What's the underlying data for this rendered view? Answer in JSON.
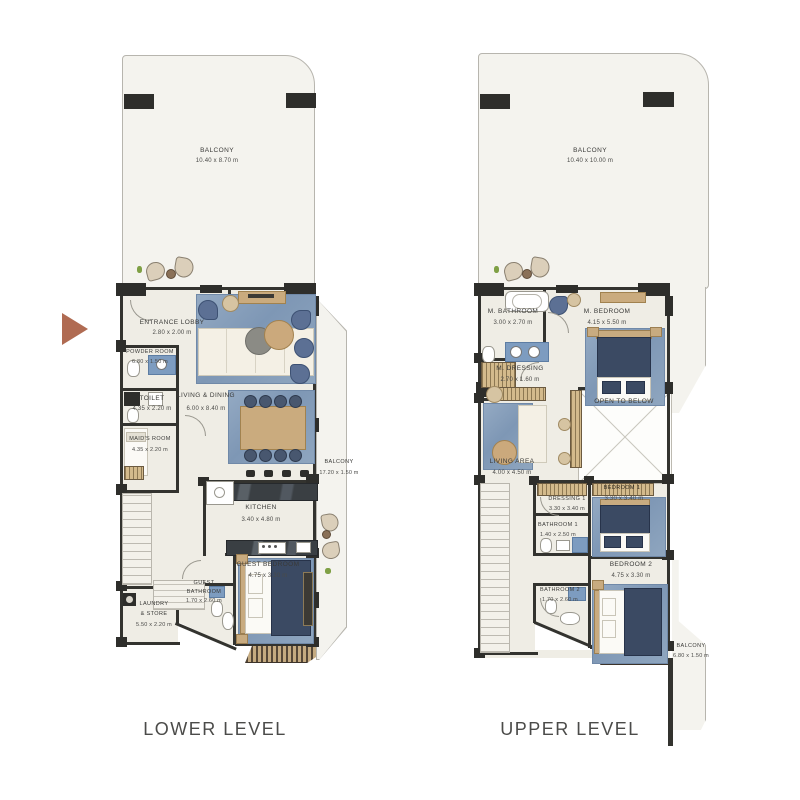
{
  "titles": {
    "lower": "LOWER LEVEL",
    "upper": "UPPER LEVEL"
  },
  "colors": {
    "wall": "#33332f",
    "floor": "#efede5",
    "balcony": "#f4f3ee",
    "rug_blue": "#8aa2bd",
    "wood": "#caab7e",
    "bed_navy": "#3b4a63",
    "entrance_arrow": "#b06b52",
    "hatch_tan": "#c8ab80"
  },
  "icons": {
    "entrance_arrow": "right-arrow"
  },
  "lower": {
    "balcony_top": {
      "label": "BALCONY",
      "dim": "10.40 x 8.70 m"
    },
    "balcony_side": {
      "label": "BALCONY",
      "dim": "17.20 x 1.50 m"
    },
    "rooms": {
      "entrance_lobby": {
        "label": "ENTRANCE LOBBY",
        "dim": "2.80 x 2.00 m"
      },
      "powder_room": {
        "label": "POWDER ROOM",
        "dim": "6.80 x 1.50 m"
      },
      "toilet": {
        "label": "TOILET",
        "dim": "4.35 x 2.20 m"
      },
      "maids_room": {
        "label": "MAID'S ROOM",
        "dim": "4.35 x 2.20 m"
      },
      "living_dining": {
        "label": "LIVING & DINING",
        "dim": "6.00 x 8.40 m"
      },
      "kitchen": {
        "label": "KITCHEN",
        "dim": "3.40 x 4.80 m"
      },
      "guest_bedroom": {
        "label": "GUEST BEDROOM",
        "dim": "4.75 x 3.30 m"
      },
      "guest_bathroom": {
        "label1": "GUEST",
        "label2": "BATHROOM",
        "dim": "1.70 x 2.60 m"
      },
      "laundry_store": {
        "label1": "LAUNDRY",
        "label2": "& STORE",
        "dim": "5.50 x 2.20 m"
      }
    }
  },
  "upper": {
    "balcony_top": {
      "label": "BALCONY",
      "dim": "10.40 x 10.00 m"
    },
    "balcony_side": {
      "label": "BALCONY",
      "dim": "6.80 x 1.50 m"
    },
    "rooms": {
      "m_bathroom": {
        "label": "M. BATHROOM",
        "dim": "3.00 x 2.70 m"
      },
      "m_bedroom": {
        "label": "M. BEDROOM",
        "dim": "4.15 x 5.50 m"
      },
      "m_dressing": {
        "label": "M. DRESSING",
        "dim": "2.70 x 1.60 m"
      },
      "open_to_below": {
        "label": "OPEN TO BELOW"
      },
      "living_area": {
        "label": "LIVING AREA",
        "dim": "4.00 x 4.50 m"
      },
      "bedroom1": {
        "label": "BEDROOM 1",
        "dim": "3.30 x 3.40 m"
      },
      "dressing1": {
        "label": "DRESSING 1",
        "dim": "3.30 x 3.40 m"
      },
      "bathroom1": {
        "label": "BATHROOM 1",
        "dim": "1.40 x 2.50 m"
      },
      "bedroom2": {
        "label": "BEDROOM 2",
        "dim": "4.75 x 3.30 m"
      },
      "bathroom2": {
        "label": "BATHROOM 2",
        "dim": "1.70 x 2.60 m"
      }
    }
  }
}
